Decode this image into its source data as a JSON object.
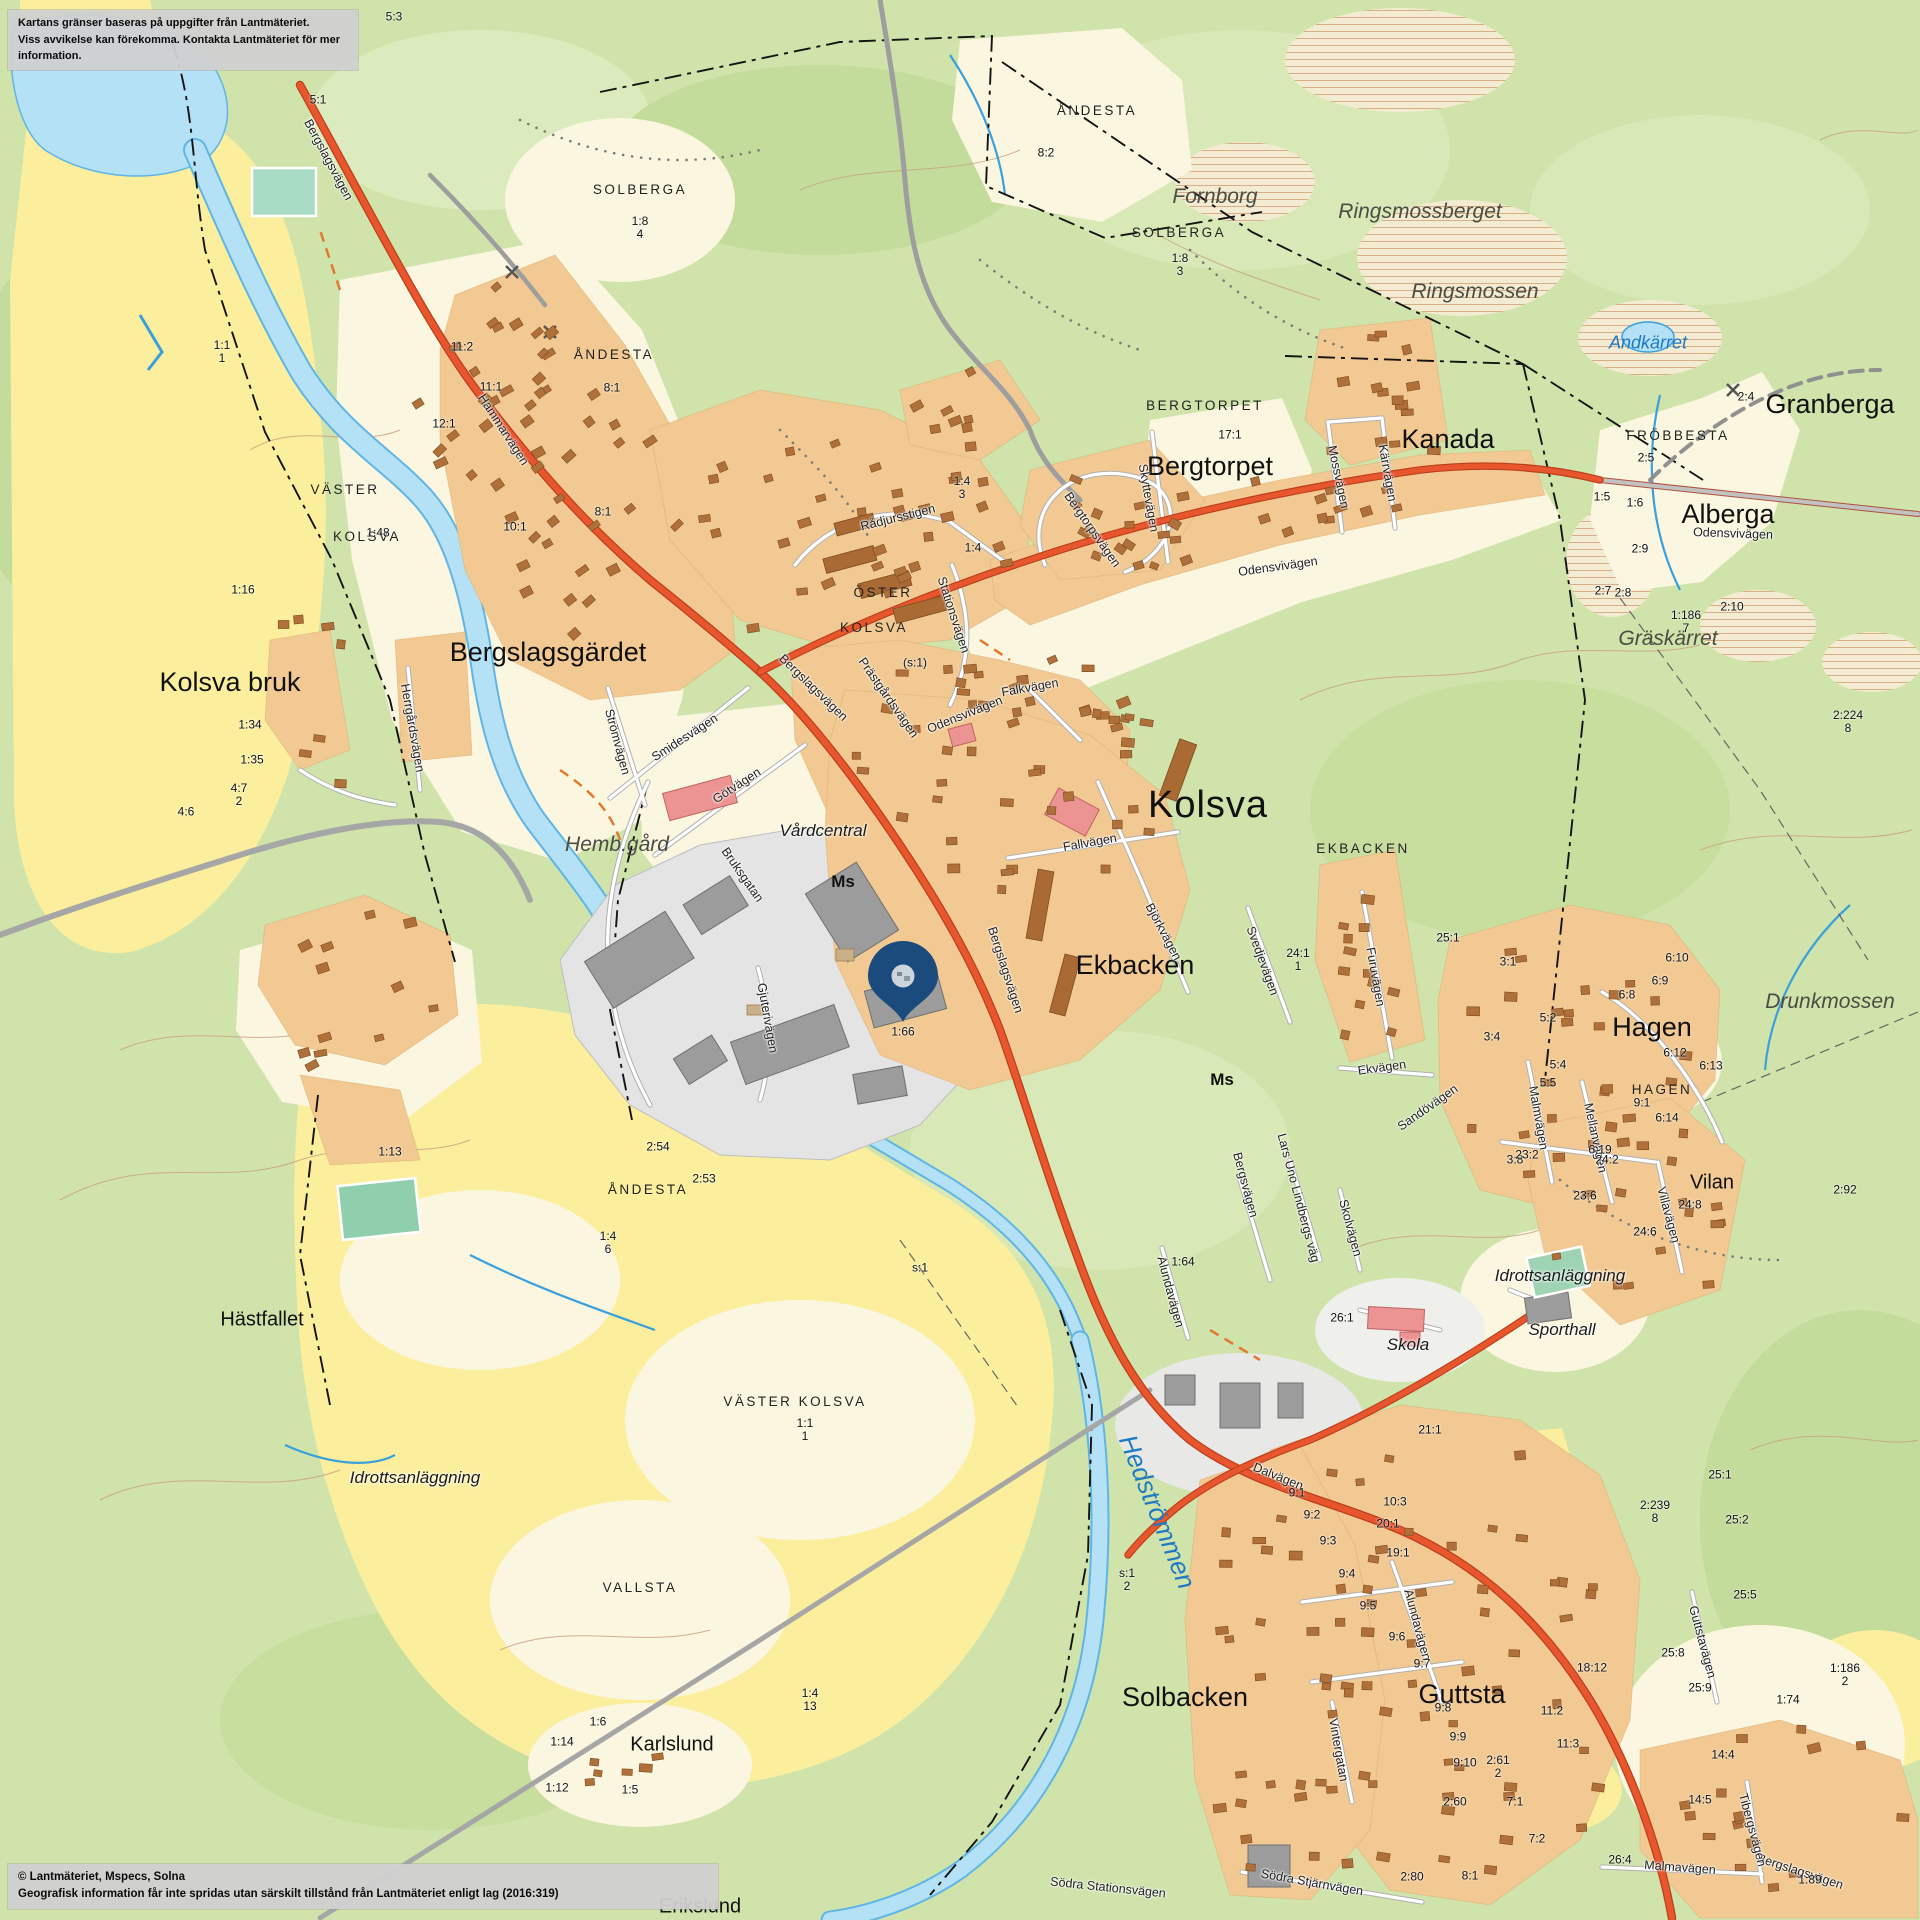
{
  "disclaimer": {
    "line1": "Kartans gränser baseras på uppgifter från Lantmäteriet.",
    "line2": "Viss avvikelse kan förekomma. Kontakta Lantmäteriet för mer information."
  },
  "copyright": {
    "line1": "© Lantmäteriet, Mspecs, Solna",
    "line2": "Geografisk information får inte spridas utan särskilt tillstånd från Lantmäteriet enligt lag (2016:319)"
  },
  "pin": {
    "x": 903,
    "y": 1022,
    "parcel_label": "1:66",
    "color": "#1b4a7d"
  },
  "colors": {
    "forest": "#cfe3ab",
    "field": "#fbef9e",
    "open_land": "#fbf6df",
    "water": "#b5e1f6",
    "water_edge": "#5fb5e6",
    "residential": "#f2c992",
    "house": "#b0703a",
    "industrial_ground": "#e4e4e4",
    "industrial_building": "#999999",
    "main_road": "#e8562e",
    "minor_road": "#ffffff",
    "public_building": "#ec9393",
    "pin": "#1b4a7d"
  },
  "labels": [
    {
      "t": "Kolsva",
      "x": 1208,
      "y": 806,
      "c": "xl"
    },
    {
      "t": "Bergslagsgärdet",
      "x": 548,
      "y": 652,
      "c": "lg"
    },
    {
      "t": "Kolsva bruk",
      "x": 230,
      "y": 682,
      "c": "lg"
    },
    {
      "t": "Hästfallet",
      "x": 262,
      "y": 1320,
      "c": "md"
    },
    {
      "t": "Ekbacken",
      "x": 1135,
      "y": 965,
      "c": "lg"
    },
    {
      "t": "Hagen",
      "x": 1652,
      "y": 1027,
      "c": "lg"
    },
    {
      "t": "Guttsta",
      "x": 1462,
      "y": 1694,
      "c": "lg"
    },
    {
      "t": "Solbacken",
      "x": 1185,
      "y": 1697,
      "c": "lg"
    },
    {
      "t": "Bergtorpet",
      "x": 1210,
      "y": 466,
      "c": "lg"
    },
    {
      "t": "Kanada",
      "x": 1448,
      "y": 439,
      "c": "lg"
    },
    {
      "t": "Granberga",
      "x": 1830,
      "y": 404,
      "c": "lg"
    },
    {
      "t": "Alberga",
      "x": 1728,
      "y": 514,
      "c": "lg"
    },
    {
      "t": "Vilan",
      "x": 1712,
      "y": 1183,
      "c": "md"
    },
    {
      "t": "Karlslund",
      "x": 672,
      "y": 1745,
      "c": "md"
    },
    {
      "t": "Erikslund",
      "x": 700,
      "y": 1907,
      "c": "md"
    },
    {
      "t": "SOLBERGA",
      "x": 640,
      "y": 190,
      "c": "caps"
    },
    {
      "t": "SOLBERGA",
      "x": 1179,
      "y": 233,
      "c": "caps"
    },
    {
      "t": "ÅNDESTA",
      "x": 614,
      "y": 355,
      "c": "caps"
    },
    {
      "t": "ÅNDESTA",
      "x": 1097,
      "y": 111,
      "c": "caps"
    },
    {
      "t": "ÅNDESTA",
      "x": 648,
      "y": 1190,
      "c": "caps"
    },
    {
      "t": "VÄSTER",
      "x": 345,
      "y": 490,
      "c": "caps"
    },
    {
      "t": "KOLSVA",
      "x": 367,
      "y": 537,
      "c": "caps"
    },
    {
      "t": "BERGTORPET",
      "x": 1205,
      "y": 406,
      "c": "caps"
    },
    {
      "t": "FRÖBBESTA",
      "x": 1678,
      "y": 436,
      "c": "caps"
    },
    {
      "t": "ÖSTER",
      "x": 883,
      "y": 593,
      "c": "caps"
    },
    {
      "t": "KOLSVA",
      "x": 874,
      "y": 628,
      "c": "caps"
    },
    {
      "t": "EKBACKEN",
      "x": 1363,
      "y": 849,
      "c": "caps"
    },
    {
      "t": "HAGEN",
      "x": 1662,
      "y": 1090,
      "c": "caps"
    },
    {
      "t": "VALLSTA",
      "x": 640,
      "y": 1588,
      "c": "caps"
    },
    {
      "t": "VÄSTER KOLSVA",
      "x": 795,
      "y": 1402,
      "c": "caps"
    },
    {
      "t": "Fornborg",
      "x": 1215,
      "y": 197,
      "c": "nat"
    },
    {
      "t": "Ringsmossberget",
      "x": 1420,
      "y": 212,
      "c": "nat"
    },
    {
      "t": "Ringsmossen",
      "x": 1475,
      "y": 292,
      "c": "nat"
    },
    {
      "t": "Gräskärret",
      "x": 1668,
      "y": 639,
      "c": "nat"
    },
    {
      "t": "Drunkmossen",
      "x": 1830,
      "y": 1002,
      "c": "nat"
    },
    {
      "t": "Hemb.gård",
      "x": 617,
      "y": 845,
      "c": "nat"
    },
    {
      "t": "Idrottsanläggning",
      "x": 415,
      "y": 1478,
      "c": "poi"
    },
    {
      "t": "Idrottsanläggning",
      "x": 1560,
      "y": 1276,
      "c": "poi"
    },
    {
      "t": "Sporthall",
      "x": 1562,
      "y": 1330,
      "c": "poi"
    },
    {
      "t": "Skola",
      "x": 1408,
      "y": 1345,
      "c": "poi"
    },
    {
      "t": "Vårdcentral",
      "x": 823,
      "y": 831,
      "c": "poi"
    },
    {
      "t": "Andkärret",
      "x": 1648,
      "y": 343,
      "c": "watsm"
    },
    {
      "t": "Hedströmmen",
      "x": 1157,
      "y": 1512,
      "c": "wat",
      "r": 68
    },
    {
      "t": "Ms",
      "x": 843,
      "y": 882,
      "c": "ms"
    },
    {
      "t": "Ms",
      "x": 1222,
      "y": 1080,
      "c": "ms"
    },
    {
      "t": "Bergslagsvägen",
      "x": 328,
      "y": 160,
      "c": "st",
      "r": 62
    },
    {
      "t": "Hammarvägen",
      "x": 503,
      "y": 430,
      "c": "st",
      "r": 57
    },
    {
      "t": "Bergslagsvägen",
      "x": 813,
      "y": 688,
      "c": "st",
      "r": 44
    },
    {
      "t": "Bergslagsvägen",
      "x": 1005,
      "y": 970,
      "c": "st",
      "r": 72
    },
    {
      "t": "Bergslagsvägen",
      "x": 1800,
      "y": 1872,
      "c": "st",
      "r": 18
    },
    {
      "t": "Odensvivägen",
      "x": 965,
      "y": 715,
      "c": "st",
      "r": -22
    },
    {
      "t": "Odensvivägen",
      "x": 1278,
      "y": 567,
      "c": "st",
      "r": -8
    },
    {
      "t": "Odensvivägen",
      "x": 1733,
      "y": 534,
      "c": "st",
      "r": 2
    },
    {
      "t": "Prästgårdsvägen",
      "x": 888,
      "y": 698,
      "c": "st",
      "r": 55
    },
    {
      "t": "Stationsvägen",
      "x": 953,
      "y": 615,
      "c": "st",
      "r": 72
    },
    {
      "t": "Rådjursstigen",
      "x": 898,
      "y": 518,
      "c": "st",
      "r": -14
    },
    {
      "t": "Skyttevägen",
      "x": 1148,
      "y": 498,
      "c": "st",
      "r": 80
    },
    {
      "t": "Bergtorpsvägen",
      "x": 1092,
      "y": 530,
      "c": "st",
      "r": 55
    },
    {
      "t": "Mossvägen",
      "x": 1338,
      "y": 477,
      "c": "st",
      "r": 78
    },
    {
      "t": "Kärrvägen",
      "x": 1387,
      "y": 473,
      "c": "st",
      "r": 80
    },
    {
      "t": "Strömvägen",
      "x": 617,
      "y": 742,
      "c": "st",
      "r": 75
    },
    {
      "t": "Smidesvägen",
      "x": 685,
      "y": 738,
      "c": "st",
      "r": -33
    },
    {
      "t": "Götvägen",
      "x": 737,
      "y": 786,
      "c": "st",
      "r": -33
    },
    {
      "t": "Bruksgatan",
      "x": 742,
      "y": 875,
      "c": "st",
      "r": 55
    },
    {
      "t": "Gjuterivägen",
      "x": 767,
      "y": 1018,
      "c": "st",
      "r": 80
    },
    {
      "t": "Fallvägen",
      "x": 1090,
      "y": 843,
      "c": "st",
      "r": -10
    },
    {
      "t": "Falkvägen",
      "x": 1030,
      "y": 688,
      "c": "st",
      "r": -10
    },
    {
      "t": "Björkvägen",
      "x": 1163,
      "y": 932,
      "c": "st",
      "r": 62
    },
    {
      "t": "Svedjevägen",
      "x": 1262,
      "y": 961,
      "c": "st",
      "r": 70
    },
    {
      "t": "Furuvägen",
      "x": 1375,
      "y": 977,
      "c": "st",
      "r": 80
    },
    {
      "t": "Ekvägen",
      "x": 1382,
      "y": 1068,
      "c": "st",
      "r": -8
    },
    {
      "t": "Sandövägen",
      "x": 1428,
      "y": 1108,
      "c": "st",
      "r": -35
    },
    {
      "t": "Mellanvägen",
      "x": 1595,
      "y": 1138,
      "c": "st",
      "r": 78
    },
    {
      "t": "Malmvägen",
      "x": 1538,
      "y": 1118,
      "c": "st",
      "r": 80
    },
    {
      "t": "Dalvägen",
      "x": 1278,
      "y": 1477,
      "c": "st",
      "r": 22
    },
    {
      "t": "Alundavägen",
      "x": 1417,
      "y": 1625,
      "c": "st",
      "r": 75
    },
    {
      "t": "Alundavägen",
      "x": 1170,
      "y": 1292,
      "c": "st",
      "r": 75
    },
    {
      "t": "Vintergatan",
      "x": 1338,
      "y": 1750,
      "c": "st",
      "r": 80
    },
    {
      "t": "Södra Stjärnvägen",
      "x": 1312,
      "y": 1883,
      "c": "st",
      "r": 10
    },
    {
      "t": "Södra Stationsvägen",
      "x": 1108,
      "y": 1888,
      "c": "st",
      "r": 6
    },
    {
      "t": "Guttstavägen",
      "x": 1702,
      "y": 1642,
      "c": "st",
      "r": 75
    },
    {
      "t": "Villavägen",
      "x": 1668,
      "y": 1215,
      "c": "st",
      "r": 75
    },
    {
      "t": "Tibergsvägen",
      "x": 1752,
      "y": 1830,
      "c": "st",
      "r": 75
    },
    {
      "t": "Malmavägen",
      "x": 1680,
      "y": 1868,
      "c": "st",
      "r": 4
    },
    {
      "t": "Bergsvägen",
      "x": 1245,
      "y": 1185,
      "c": "st",
      "r": 75
    },
    {
      "t": "Lars Uno Lindbergs väg",
      "x": 1298,
      "y": 1198,
      "c": "st",
      "r": 75
    },
    {
      "t": "Skolvägen",
      "x": 1350,
      "y": 1228,
      "c": "st",
      "r": 75
    },
    {
      "t": "Herrgårdsvägen",
      "x": 412,
      "y": 728,
      "c": "st",
      "r": 80
    },
    {
      "t": "5:3",
      "x": 394,
      "y": 17,
      "c": "pc"
    },
    {
      "t": "5:1",
      "x": 318,
      "y": 100,
      "c": "pc"
    },
    {
      "t": "8:2",
      "x": 1046,
      "y": 153,
      "c": "pc"
    },
    {
      "t": "1:8\n4",
      "x": 640,
      "y": 228,
      "c": "pc"
    },
    {
      "t": "1:8\n3",
      "x": 1180,
      "y": 265,
      "c": "pc"
    },
    {
      "t": "17:1",
      "x": 1230,
      "y": 435,
      "c": "pc"
    },
    {
      "t": "1:1\n1",
      "x": 222,
      "y": 352,
      "c": "pc"
    },
    {
      "t": "11:2",
      "x": 462,
      "y": 347,
      "c": "pc"
    },
    {
      "t": "11:1",
      "x": 491,
      "y": 387,
      "c": "pc"
    },
    {
      "t": "12:1",
      "x": 444,
      "y": 424,
      "c": "pc"
    },
    {
      "t": "8:1",
      "x": 612,
      "y": 388,
      "c": "pc"
    },
    {
      "t": "8:1",
      "x": 603,
      "y": 512,
      "c": "pc"
    },
    {
      "t": "10:1",
      "x": 515,
      "y": 527,
      "c": "pc"
    },
    {
      "t": "1:48",
      "x": 378,
      "y": 533,
      "c": "pc"
    },
    {
      "t": "1:16",
      "x": 243,
      "y": 590,
      "c": "pc"
    },
    {
      "t": "1:34",
      "x": 250,
      "y": 725,
      "c": "pc"
    },
    {
      "t": "1:35",
      "x": 252,
      "y": 760,
      "c": "pc"
    },
    {
      "t": "4:7\n2",
      "x": 239,
      "y": 795,
      "c": "pc"
    },
    {
      "t": "4:6",
      "x": 186,
      "y": 812,
      "c": "pc"
    },
    {
      "t": "(s:1)",
      "x": 915,
      "y": 663,
      "c": "pc"
    },
    {
      "t": "1:4\n3",
      "x": 962,
      "y": 488,
      "c": "pc"
    },
    {
      "t": "1:4",
      "x": 973,
      "y": 548,
      "c": "pc"
    },
    {
      "t": "1:66",
      "x": 903,
      "y": 1032,
      "c": "pc"
    },
    {
      "t": "24:1\n1",
      "x": 1298,
      "y": 960,
      "c": "pc"
    },
    {
      "t": "25:1",
      "x": 1448,
      "y": 938,
      "c": "pc"
    },
    {
      "t": "3:1",
      "x": 1508,
      "y": 962,
      "c": "pc"
    },
    {
      "t": "5:2",
      "x": 1548,
      "y": 1018,
      "c": "pc"
    },
    {
      "t": "3:4",
      "x": 1492,
      "y": 1037,
      "c": "pc"
    },
    {
      "t": "5:4",
      "x": 1558,
      "y": 1065,
      "c": "pc"
    },
    {
      "t": "5:5",
      "x": 1548,
      "y": 1083,
      "c": "pc"
    },
    {
      "t": "9:1",
      "x": 1642,
      "y": 1103,
      "c": "pc"
    },
    {
      "t": "6:10",
      "x": 1677,
      "y": 958,
      "c": "pc"
    },
    {
      "t": "6:9",
      "x": 1660,
      "y": 981,
      "c": "pc"
    },
    {
      "t": "6:8",
      "x": 1627,
      "y": 995,
      "c": "pc"
    },
    {
      "t": "6:12",
      "x": 1675,
      "y": 1053,
      "c": "pc"
    },
    {
      "t": "6:13",
      "x": 1711,
      "y": 1066,
      "c": "pc"
    },
    {
      "t": "6:14",
      "x": 1667,
      "y": 1118,
      "c": "pc"
    },
    {
      "t": "6:19",
      "x": 1600,
      "y": 1150,
      "c": "pc"
    },
    {
      "t": "3:8",
      "x": 1515,
      "y": 1160,
      "c": "pc"
    },
    {
      "t": "2:4",
      "x": 1746,
      "y": 397,
      "c": "pc"
    },
    {
      "t": "2:5",
      "x": 1646,
      "y": 458,
      "c": "pc"
    },
    {
      "t": "1:5",
      "x": 1602,
      "y": 497,
      "c": "pc"
    },
    {
      "t": "1:6",
      "x": 1635,
      "y": 503,
      "c": "pc"
    },
    {
      "t": "2:9",
      "x": 1640,
      "y": 549,
      "c": "pc"
    },
    {
      "t": "2:7",
      "x": 1603,
      "y": 591,
      "c": "pc"
    },
    {
      "t": "2:8",
      "x": 1623,
      "y": 593,
      "c": "pc"
    },
    {
      "t": "2:10",
      "x": 1732,
      "y": 607,
      "c": "pc"
    },
    {
      "t": "1:186\n7",
      "x": 1686,
      "y": 622,
      "c": "pc"
    },
    {
      "t": "2:224\n8",
      "x": 1848,
      "y": 722,
      "c": "pc"
    },
    {
      "t": "25:1",
      "x": 1720,
      "y": 1475,
      "c": "pc"
    },
    {
      "t": "21:1",
      "x": 1430,
      "y": 1430,
      "c": "pc"
    },
    {
      "t": "10:3",
      "x": 1395,
      "y": 1502,
      "c": "pc"
    },
    {
      "t": "9:1",
      "x": 1297,
      "y": 1493,
      "c": "pc"
    },
    {
      "t": "9:2",
      "x": 1312,
      "y": 1515,
      "c": "pc"
    },
    {
      "t": "9:3",
      "x": 1328,
      "y": 1541,
      "c": "pc"
    },
    {
      "t": "9:4",
      "x": 1347,
      "y": 1574,
      "c": "pc"
    },
    {
      "t": "9:5",
      "x": 1368,
      "y": 1606,
      "c": "pc"
    },
    {
      "t": "9:6",
      "x": 1397,
      "y": 1637,
      "c": "pc"
    },
    {
      "t": "9:7",
      "x": 1422,
      "y": 1664,
      "c": "pc"
    },
    {
      "t": "9:8",
      "x": 1443,
      "y": 1708,
      "c": "pc"
    },
    {
      "t": "9:9",
      "x": 1458,
      "y": 1737,
      "c": "pc"
    },
    {
      "t": "9:10",
      "x": 1465,
      "y": 1763,
      "c": "pc"
    },
    {
      "t": "2:61\n2",
      "x": 1498,
      "y": 1767,
      "c": "pc"
    },
    {
      "t": "2:60",
      "x": 1455,
      "y": 1802,
      "c": "pc"
    },
    {
      "t": "7:1",
      "x": 1515,
      "y": 1802,
      "c": "pc"
    },
    {
      "t": "7:2",
      "x": 1537,
      "y": 1839,
      "c": "pc"
    },
    {
      "t": "2:80",
      "x": 1412,
      "y": 1877,
      "c": "pc"
    },
    {
      "t": "8:1",
      "x": 1470,
      "y": 1876,
      "c": "pc"
    },
    {
      "t": "11:2",
      "x": 1552,
      "y": 1711,
      "c": "pc"
    },
    {
      "t": "11:3",
      "x": 1568,
      "y": 1744,
      "c": "pc"
    },
    {
      "t": "18:12",
      "x": 1592,
      "y": 1668,
      "c": "pc"
    },
    {
      "t": "20:1",
      "x": 1388,
      "y": 1524,
      "c": "pc"
    },
    {
      "t": "19:1",
      "x": 1398,
      "y": 1553,
      "c": "pc"
    },
    {
      "t": "26:1",
      "x": 1342,
      "y": 1318,
      "c": "pc"
    },
    {
      "t": "1:64",
      "x": 1183,
      "y": 1262,
      "c": "pc"
    },
    {
      "t": "23:2",
      "x": 1527,
      "y": 1155,
      "c": "pc"
    },
    {
      "t": "24:2",
      "x": 1607,
      "y": 1160,
      "c": "pc"
    },
    {
      "t": "23:6",
      "x": 1585,
      "y": 1196,
      "c": "pc"
    },
    {
      "t": "24:8",
      "x": 1690,
      "y": 1205,
      "c": "pc"
    },
    {
      "t": "24:6",
      "x": 1645,
      "y": 1232,
      "c": "pc"
    },
    {
      "t": "2:92",
      "x": 1845,
      "y": 1190,
      "c": "pc"
    },
    {
      "t": "2:239\n8",
      "x": 1655,
      "y": 1512,
      "c": "pc"
    },
    {
      "t": "25:2",
      "x": 1737,
      "y": 1520,
      "c": "pc"
    },
    {
      "t": "25:5",
      "x": 1745,
      "y": 1595,
      "c": "pc"
    },
    {
      "t": "25:8",
      "x": 1673,
      "y": 1653,
      "c": "pc"
    },
    {
      "t": "25:9",
      "x": 1700,
      "y": 1688,
      "c": "pc"
    },
    {
      "t": "1:186\n2",
      "x": 1845,
      "y": 1675,
      "c": "pc"
    },
    {
      "t": "1:74",
      "x": 1788,
      "y": 1700,
      "c": "pc"
    },
    {
      "t": "14:4",
      "x": 1723,
      "y": 1755,
      "c": "pc"
    },
    {
      "t": "14:5",
      "x": 1700,
      "y": 1800,
      "c": "pc"
    },
    {
      "t": "26:4",
      "x": 1620,
      "y": 1860,
      "c": "pc"
    },
    {
      "t": "1:89",
      "x": 1810,
      "y": 1880,
      "c": "pc"
    },
    {
      "t": "s:1\n2",
      "x": 1127,
      "y": 1580,
      "c": "pc"
    },
    {
      "t": "s:1",
      "x": 920,
      "y": 1268,
      "c": "pc"
    },
    {
      "t": "2:54",
      "x": 658,
      "y": 1147,
      "c": "pc"
    },
    {
      "t": "2:53",
      "x": 704,
      "y": 1179,
      "c": "pc"
    },
    {
      "t": "1:4\n6",
      "x": 608,
      "y": 1243,
      "c": "pc"
    },
    {
      "t": "1:13",
      "x": 390,
      "y": 1152,
      "c": "pc"
    },
    {
      "t": "1:4\n13",
      "x": 810,
      "y": 1700,
      "c": "pc"
    },
    {
      "t": "1:14",
      "x": 562,
      "y": 1742,
      "c": "pc"
    },
    {
      "t": "1:6",
      "x": 598,
      "y": 1722,
      "c": "pc"
    },
    {
      "t": "1:12",
      "x": 557,
      "y": 1788,
      "c": "pc"
    },
    {
      "t": "1:5",
      "x": 630,
      "y": 1790,
      "c": "pc"
    },
    {
      "t": "1:1\n1",
      "x": 805,
      "y": 1430,
      "c": "pc"
    }
  ]
}
